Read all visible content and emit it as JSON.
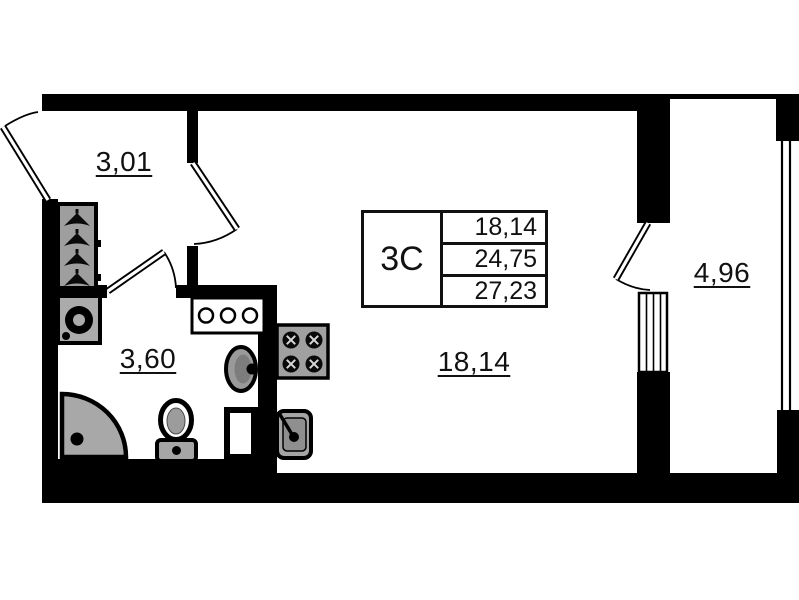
{
  "unit": {
    "type_label": "3C",
    "area_rows": [
      "18,14",
      "24,75",
      "27,23"
    ]
  },
  "rooms": {
    "hallway": {
      "area_label": "3,01"
    },
    "bathroom": {
      "area_label": "3,60"
    },
    "living_room": {
      "area_label": "18,14"
    },
    "balcony": {
      "area_label": "4,96"
    }
  },
  "fixtures": {
    "hallway": [
      "wardrobe-with-hangers"
    ],
    "bathroom": [
      "washing-machine",
      "shower-tray",
      "toilet",
      "wall-sink",
      "vent-shaft"
    ],
    "kitchen": [
      "stove-4-burners",
      "kitchen-sink",
      "utility-risers-3-pipes"
    ],
    "openings": [
      "entrance-door",
      "hallway-door",
      "bathroom-door",
      "balcony-door",
      "balcony-partition-window",
      "facade-window"
    ]
  },
  "colors": {
    "wall": "#000000",
    "fixture_fill": "#a3a3a3",
    "background": "#ffffff",
    "text": "#111111"
  }
}
